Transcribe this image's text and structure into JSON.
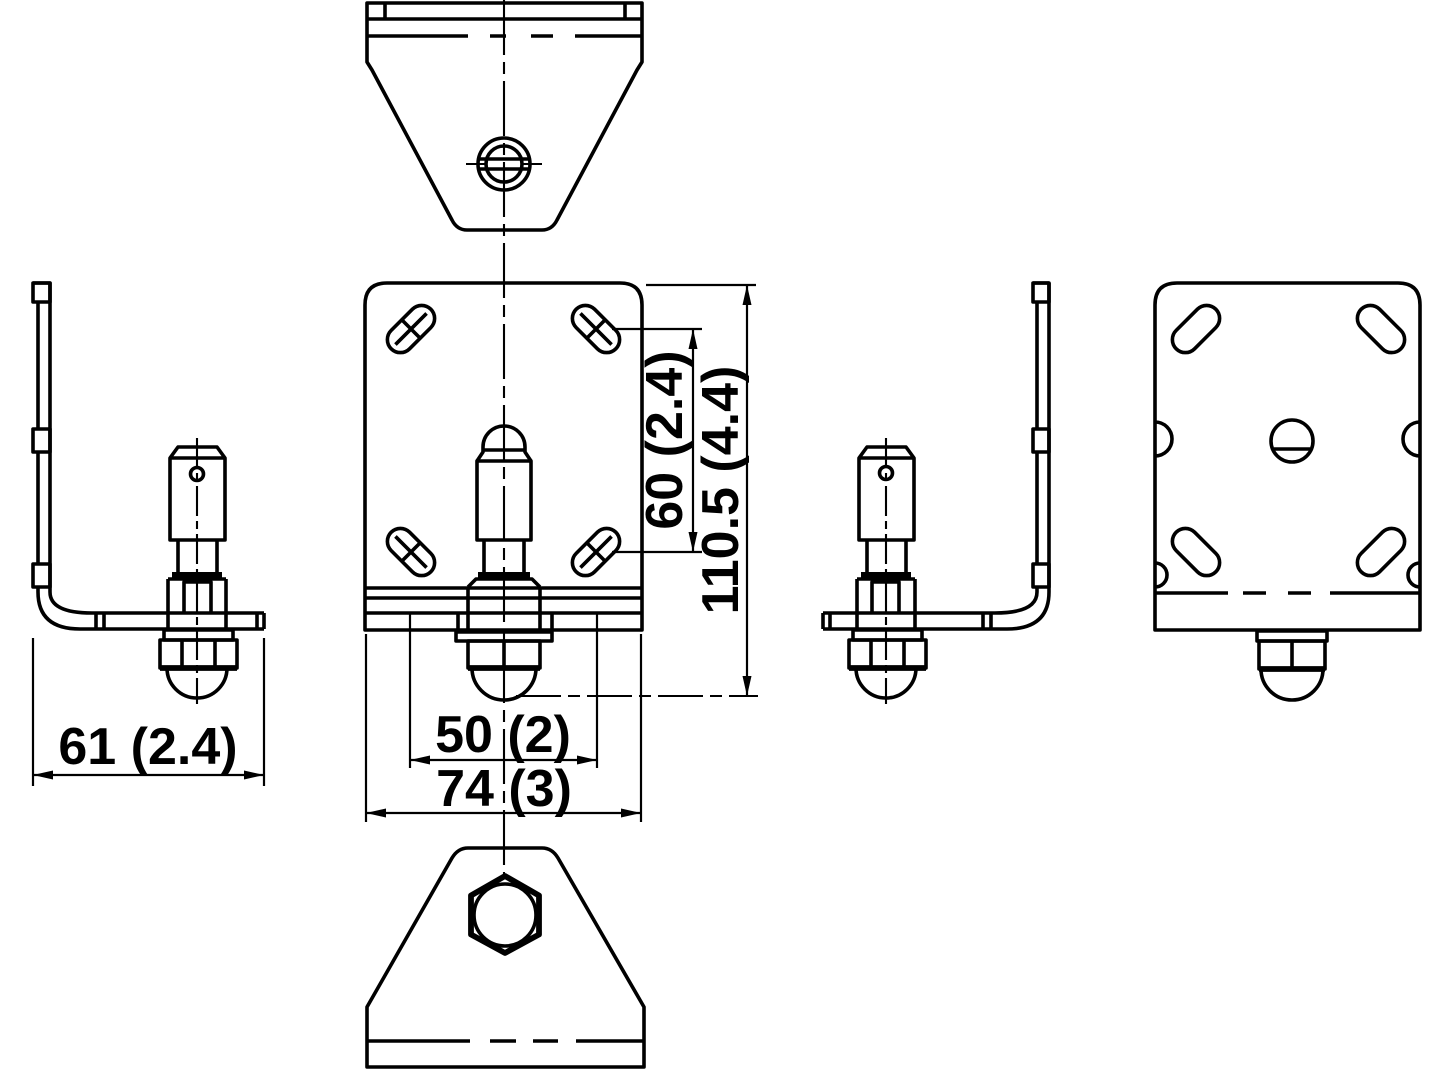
{
  "page": {
    "background": "#ffffff",
    "line_color": "#000000",
    "description": "six-view engineering drawing of an L-shaped mounting bracket with ball stud"
  },
  "dimensions": {
    "bracket_depth": {
      "label": "61 (2.4)"
    },
    "slot_spacing_horizontal": {
      "label": "50 (2)"
    },
    "plate_width": {
      "label": "74 (3)"
    },
    "slot_spacing_vertical": {
      "label": "60 (2.4)"
    },
    "overall_height": {
      "label": "110.5 (4.4)"
    }
  }
}
